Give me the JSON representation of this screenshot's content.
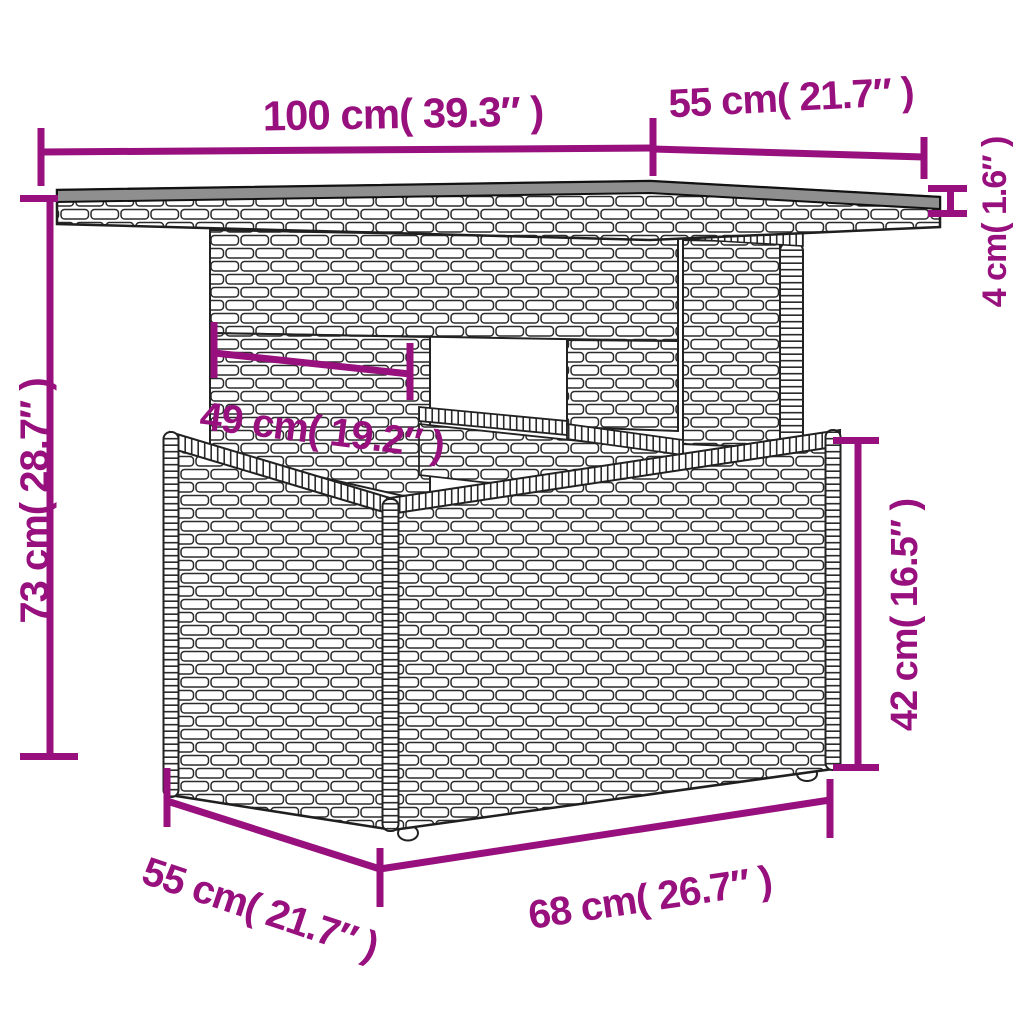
{
  "page": {
    "type": "product-dimension-diagram",
    "subject": "poly-rattan-garden-table",
    "background": "#ffffff"
  },
  "style": {
    "accent_color": "#97107E",
    "line_art_color": "#222222",
    "tabletop_surface_color": "#8f8f8f"
  },
  "dimensions": {
    "top_width": "100 cm( 39.3″ )",
    "top_depth": "55 cm( 21.7″ )",
    "top_thickness": "4 cm( 1.6″ )",
    "overall_height": "73 cm( 28.7″ )",
    "pedestal_width": "49 cm( 19.2″ )",
    "base_height": "42 cm( 16.5″ )",
    "base_depth": "55 cm( 21.7″ )",
    "base_width": "68 cm( 26.7″ )"
  }
}
